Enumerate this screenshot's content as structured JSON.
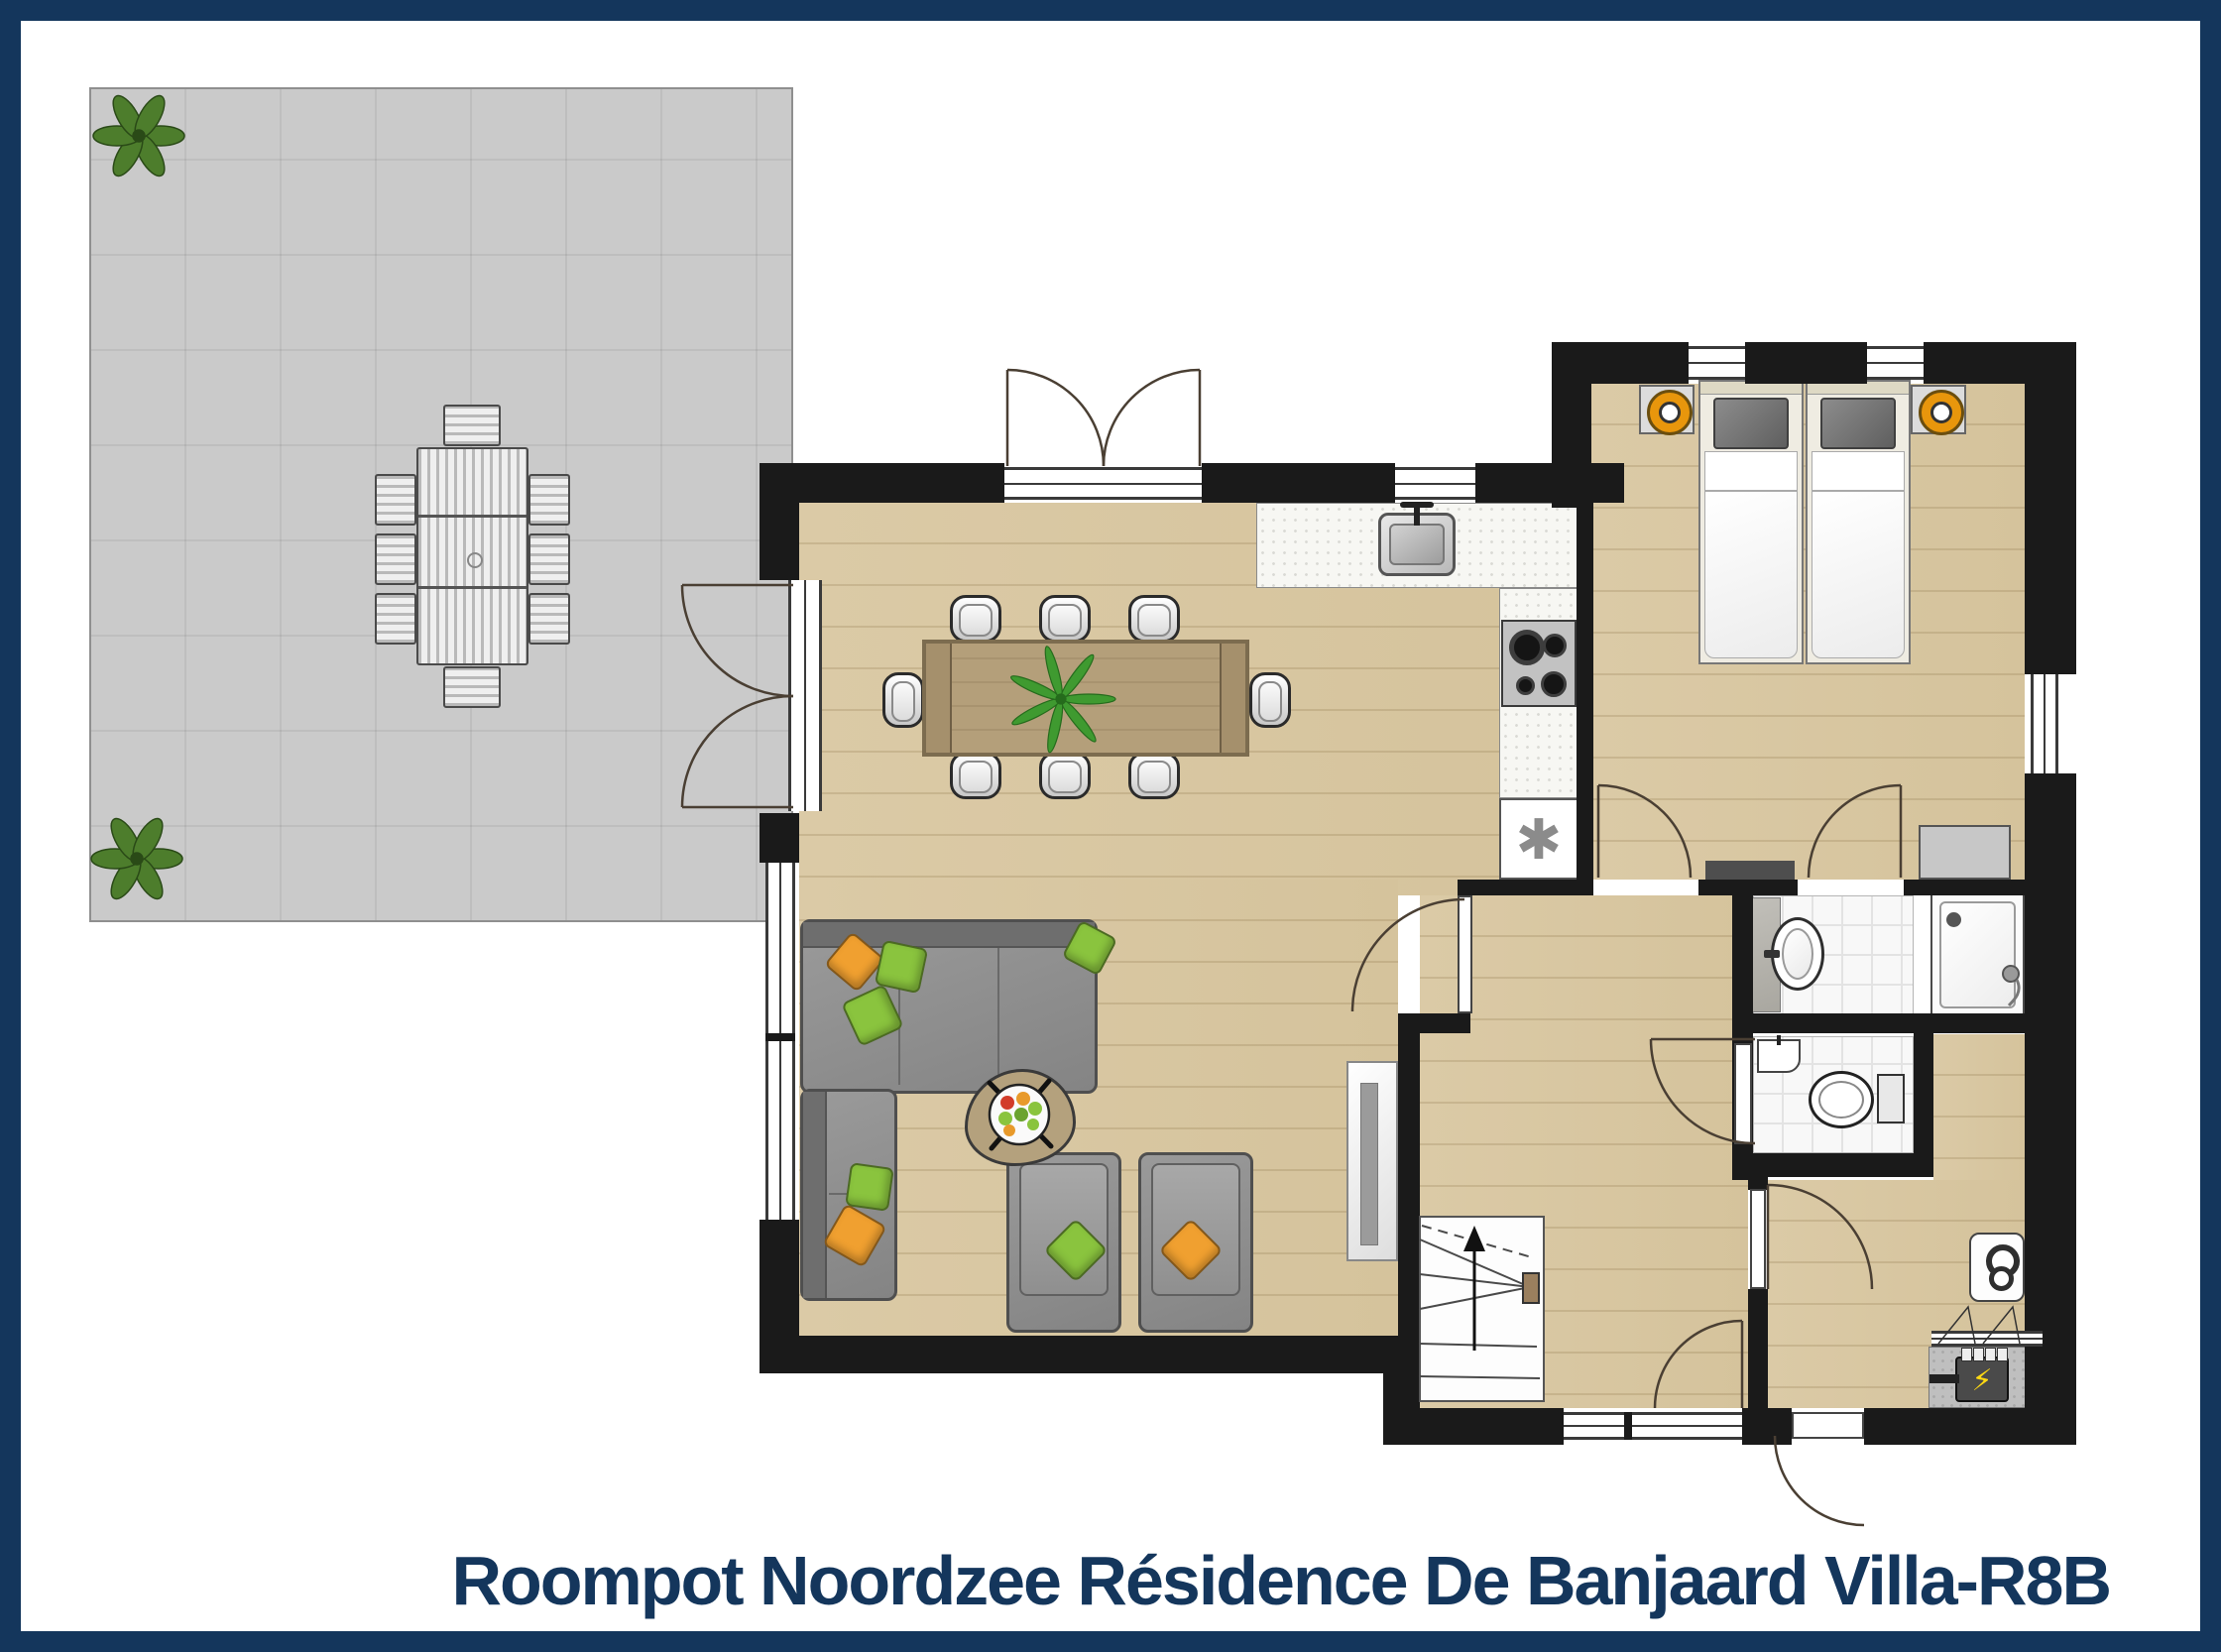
{
  "title": "Roompot Noordzee Résidence De Banjaard Villa-R8B",
  "symbols": {
    "freezer": "✱",
    "electric_meter": "⚡"
  },
  "colors": {
    "frame": "#14365c",
    "title_text": "#14365c",
    "walls": "#1a1a1a",
    "wood_floor": "#d9c8a3",
    "terrace": "#cacaca",
    "bathroom_tile": "#f8f8f8",
    "kitchen_counter": "#f7f7f3",
    "sofa_gray": "#8f8f8f",
    "cushion_green": "#8ac43e",
    "cushion_orange": "#f0a030",
    "lamp_orange": "#e8960c",
    "meter_bolt": "#ffd912"
  }
}
